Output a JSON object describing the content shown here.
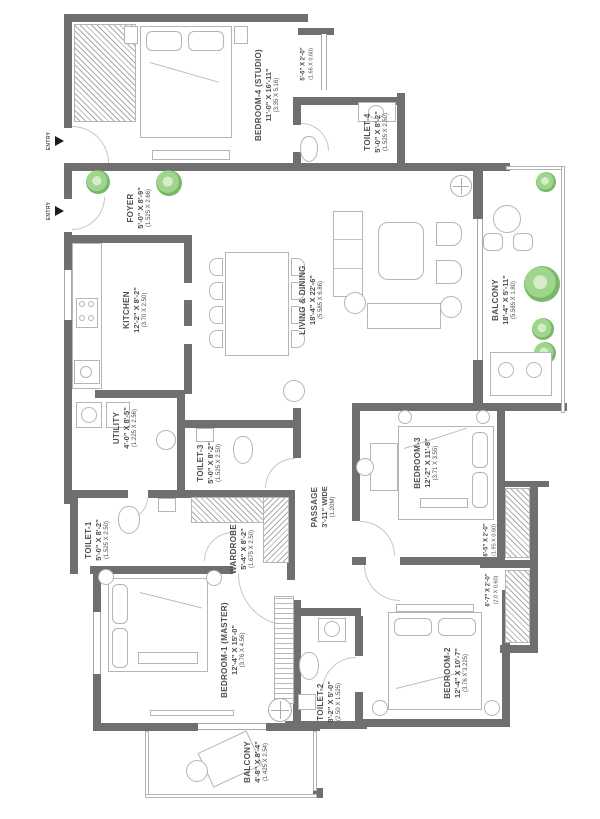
{
  "plan": {
    "colors": {
      "wall": "#6f6f6f",
      "furniture": "#b5b5b5",
      "plant": "#7cc46a",
      "text": "#4e4e4e"
    },
    "entries": [
      {
        "label": "ENTRY"
      },
      {
        "label": "ENTRY"
      }
    ],
    "rooms": [
      {
        "name": "BEDROOM-4 (STUDIO)",
        "dim": "11'-0\" X 16'-11\"",
        "metric": "(3.35 X 5.16)"
      },
      {
        "name": "",
        "dim": "5'-6\" X 2'-0\"",
        "metric": "(1.66 X 0.60)"
      },
      {
        "name": "TOILET-4",
        "dim": "5'-0\" X 8'-2\"",
        "metric": "(1.525 X 2.50)"
      },
      {
        "name": "FOYER",
        "dim": "5'-0\" X 8'-9\"",
        "metric": "(1.525 X 2.66)"
      },
      {
        "name": "KITCHEN",
        "dim": "12'-2\" X 8'-2\"",
        "metric": "(3.70 X 2.50)"
      },
      {
        "name": "LIVING & DINING",
        "dim": "18'-4\" X 22'-6\"",
        "metric": "(5.585 X 6.86)"
      },
      {
        "name": "BALCONY",
        "dim": "18'-4\" X 5'-11\"",
        "metric": "(5.585 X 1.80)"
      },
      {
        "name": "UTILITY",
        "dim": "4'-0\" X 8'-5\"",
        "metric": "(1.225 X 2.56)"
      },
      {
        "name": "TOILET-3",
        "dim": "5'-0\" X 8'-2\"",
        "metric": "(1.525 X 2.50)"
      },
      {
        "name": "TOILET-1",
        "dim": "5'-0\" X 8'-2\"",
        "metric": "(1.525 X 2.50)"
      },
      {
        "name": "WARDROBE",
        "dim": "5'-4\" X 8'-2\"",
        "metric": "(1.675 X 2.50)"
      },
      {
        "name": "PASSAGE",
        "dim": "3'-11\" WIDE",
        "metric": "(1.20M)"
      },
      {
        "name": "BEDROOM-3",
        "dim": "12'-2\" X 11'-8\"",
        "metric": "(3.71 X 3.55)"
      },
      {
        "name": "",
        "dim": "6'-5\" X 2'-0\"",
        "metric": "(1.95 X 0.60)"
      },
      {
        "name": "",
        "dim": "6'-7\" X 2'-0\"",
        "metric": "(2.0 X 0.60)"
      },
      {
        "name": "BEDROOM-1 (MASTER)",
        "dim": "12'-4\" X 15'-0\"",
        "metric": "(3.76 X 4.56)"
      },
      {
        "name": "TOILET-2",
        "dim": "8'-2\" X 5'-0\"",
        "metric": "(2.50 X 1.525)"
      },
      {
        "name": "BEDROOM-2",
        "dim": "12'-4\" X 10'-7\"",
        "metric": "(3.76 X 3.225)"
      },
      {
        "name": "BALCONY",
        "dim": "4'-8\" X 8'-4\"",
        "metric": "(1.425 X 2.54)"
      }
    ]
  }
}
